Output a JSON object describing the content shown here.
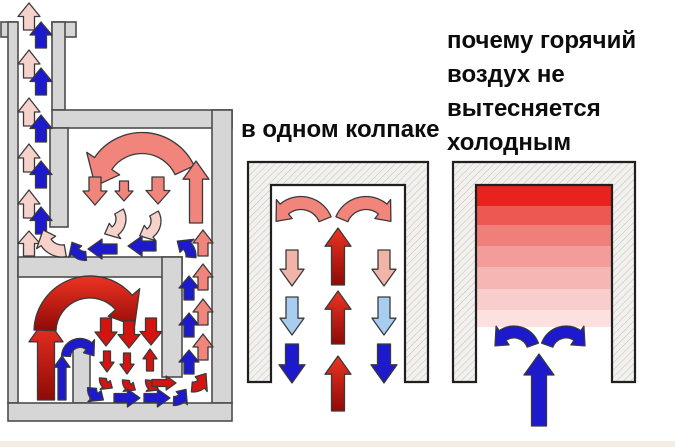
{
  "palette": {
    "hot_red": "#d41410",
    "red_deep": "#8f0a06",
    "red_bright": "#ee3323",
    "salmon": "#f2857b",
    "blush": "#f2b4a9",
    "pale_pink": "#f6d2cb",
    "dark_blue": "#1d19cd",
    "light_blue": "#a9cdf1",
    "wall_gray": "#d6d6d6",
    "wall_outline": "#4c4c4c",
    "bell_outline": "#1f1f1f",
    "hatch_line": "#c3c3c3",
    "hatch_bg": "#f2f1ee",
    "arrow_outline": "#3a3a3a",
    "title_color": "#0c0c0c",
    "footer_stripe": "#f4ece7"
  },
  "diagrams": {
    "two_bell_stove": {
      "arrows": [
        {
          "t": "s",
          "x1": 29,
          "y1": 30,
          "x2": 29,
          "y2": 3,
          "w": 11,
          "c": "pale_pink"
        },
        {
          "t": "s",
          "x1": 29,
          "y1": 78,
          "x2": 29,
          "y2": 50,
          "w": 11,
          "c": "pale_pink"
        },
        {
          "t": "s",
          "x1": 29,
          "y1": 126,
          "x2": 29,
          "y2": 98,
          "w": 11,
          "c": "pale_pink"
        },
        {
          "t": "s",
          "x1": 29,
          "y1": 172,
          "x2": 29,
          "y2": 144,
          "w": 11,
          "c": "pale_pink"
        },
        {
          "t": "s",
          "x1": 29,
          "y1": 218,
          "x2": 29,
          "y2": 190,
          "w": 11,
          "c": "pale_pink"
        },
        {
          "t": "s",
          "x1": 29,
          "y1": 256,
          "x2": 29,
          "y2": 231,
          "w": 11,
          "c": "pale_pink"
        },
        {
          "t": "s",
          "x1": 41,
          "y1": 48,
          "x2": 41,
          "y2": 22,
          "w": 11,
          "c": "dark_blue"
        },
        {
          "t": "s",
          "x1": 41,
          "y1": 95,
          "x2": 41,
          "y2": 68,
          "w": 11,
          "c": "dark_blue"
        },
        {
          "t": "s",
          "x1": 41,
          "y1": 142,
          "x2": 41,
          "y2": 115,
          "w": 11,
          "c": "dark_blue"
        },
        {
          "t": "s",
          "x1": 41,
          "y1": 188,
          "x2": 41,
          "y2": 161,
          "w": 11,
          "c": "dark_blue"
        },
        {
          "t": "s",
          "x1": 41,
          "y1": 234,
          "x2": 41,
          "y2": 207,
          "w": 11,
          "c": "dark_blue"
        },
        {
          "t": "a",
          "cx": 142,
          "cy": 190,
          "r": 47,
          "w": 21,
          "a0": -25,
          "a1": -175,
          "hl": 24,
          "c": "salmon"
        },
        {
          "t": "s",
          "x1": 95,
          "y1": 177,
          "x2": 95,
          "y2": 205,
          "w": 12,
          "c": "salmon"
        },
        {
          "t": "s",
          "x1": 124,
          "y1": 181,
          "x2": 124,
          "y2": 201,
          "w": 9,
          "c": "salmon"
        },
        {
          "t": "s",
          "x1": 158,
          "y1": 177,
          "x2": 158,
          "y2": 204,
          "w": 12,
          "c": "salmon"
        },
        {
          "t": "s",
          "x1": 196,
          "y1": 223,
          "x2": 196,
          "y2": 161,
          "w": 13,
          "c": "salmon"
        },
        {
          "t": "s",
          "x1": 203,
          "y1": 256,
          "x2": 203,
          "y2": 230,
          "w": 10,
          "c": "salmon"
        },
        {
          "t": "a",
          "cx": 106,
          "cy": 219,
          "r": 15,
          "w": 10,
          "a0": -30,
          "a1": 95,
          "hl": 11,
          "c": "pale_pink"
        },
        {
          "t": "a",
          "cx": 141,
          "cy": 221,
          "r": 15,
          "w": 10,
          "a0": -30,
          "a1": 95,
          "hl": 11,
          "c": "pale_pink"
        },
        {
          "t": "a",
          "cx": 62,
          "cy": 232,
          "r": 19,
          "w": 12,
          "a0": 80,
          "a1": 186,
          "hl": 13,
          "c": "pale_pink"
        },
        {
          "t": "s",
          "x1": 117,
          "y1": 249,
          "x2": 88,
          "y2": 249,
          "w": 10,
          "c": "dark_blue"
        },
        {
          "t": "s",
          "x1": 156,
          "y1": 246,
          "x2": 128,
          "y2": 246,
          "w": 10,
          "c": "dark_blue"
        },
        {
          "t": "a",
          "cx": 176,
          "cy": 256,
          "r": 15,
          "w": 10,
          "a0": 5,
          "a1": -85,
          "hl": 11,
          "c": "dark_blue"
        },
        {
          "t": "a",
          "cx": 85,
          "cy": 243,
          "r": 13,
          "w": 9,
          "a0": 85,
          "a1": 183,
          "hl": 10,
          "c": "dark_blue"
        },
        {
          "t": "s",
          "x1": 46,
          "y1": 400,
          "x2": 46,
          "y2": 318,
          "w": 17,
          "c": "red_grad"
        },
        {
          "t": "a",
          "cx": 90,
          "cy": 332,
          "r": 45,
          "w": 22,
          "a0": 182,
          "a1": 352,
          "hl": 26,
          "c": "red_grad"
        },
        {
          "t": "s",
          "x1": 106,
          "y1": 318,
          "x2": 106,
          "y2": 346,
          "w": 11,
          "c": "hot_red"
        },
        {
          "t": "s",
          "x1": 129,
          "y1": 321,
          "x2": 129,
          "y2": 348,
          "w": 11,
          "c": "hot_red"
        },
        {
          "t": "s",
          "x1": 151,
          "y1": 318,
          "x2": 151,
          "y2": 345,
          "w": 11,
          "c": "hot_red"
        },
        {
          "t": "s",
          "x1": 107,
          "y1": 351,
          "x2": 107,
          "y2": 372,
          "w": 7,
          "c": "hot_red"
        },
        {
          "t": "s",
          "x1": 127,
          "y1": 353,
          "x2": 127,
          "y2": 374,
          "w": 7,
          "c": "hot_red"
        },
        {
          "t": "s",
          "x1": 150,
          "y1": 371,
          "x2": 150,
          "y2": 349,
          "w": 7,
          "c": "hot_red"
        },
        {
          "t": "a",
          "cx": 112,
          "cy": 379,
          "r": 9,
          "w": 7,
          "a0": 185,
          "a1": 88,
          "hl": 8,
          "c": "hot_red"
        },
        {
          "t": "a",
          "cx": 135,
          "cy": 381,
          "r": 9,
          "w": 7,
          "a0": 185,
          "a1": 88,
          "hl": 8,
          "c": "hot_red"
        },
        {
          "t": "a",
          "cx": 158,
          "cy": 381,
          "r": 9,
          "w": 7,
          "a0": 185,
          "a1": 88,
          "hl": 8,
          "c": "hot_red"
        },
        {
          "t": "a",
          "cx": 80,
          "cy": 357,
          "r": 14,
          "w": 9,
          "a0": 183,
          "a1": 355,
          "hl": 11,
          "c": "dark_blue"
        },
        {
          "t": "s",
          "x1": 62,
          "y1": 400,
          "x2": 62,
          "y2": 356,
          "w": 8,
          "c": "dark_blue"
        },
        {
          "t": "a",
          "cx": 103,
          "cy": 389,
          "r": 11,
          "w": 9,
          "a0": 185,
          "a1": 88,
          "hl": 10,
          "c": "dark_blue"
        },
        {
          "t": "s",
          "x1": 114,
          "y1": 398,
          "x2": 140,
          "y2": 398,
          "w": 9,
          "c": "dark_blue"
        },
        {
          "t": "s",
          "x1": 144,
          "y1": 398,
          "x2": 170,
          "y2": 398,
          "w": 9,
          "c": "dark_blue"
        },
        {
          "t": "a",
          "cx": 174,
          "cy": 389,
          "r": 12,
          "w": 9,
          "a0": 92,
          "a1": 2,
          "hl": 10,
          "c": "dark_blue"
        },
        {
          "t": "s",
          "x1": 152,
          "y1": 383,
          "x2": 176,
          "y2": 383,
          "w": 7,
          "c": "hot_red"
        },
        {
          "t": "a",
          "cx": 193,
          "cy": 374,
          "r": 13,
          "w": 10,
          "a0": 95,
          "a1": -2,
          "hl": 12,
          "c": "hot_red"
        },
        {
          "t": "s",
          "x1": 189,
          "y1": 300,
          "x2": 189,
          "y2": 276,
          "w": 10,
          "c": "dark_blue"
        },
        {
          "t": "s",
          "x1": 189,
          "y1": 337,
          "x2": 189,
          "y2": 313,
          "w": 10,
          "c": "dark_blue"
        },
        {
          "t": "s",
          "x1": 189,
          "y1": 374,
          "x2": 189,
          "y2": 350,
          "w": 10,
          "c": "dark_blue"
        },
        {
          "t": "s",
          "x1": 203,
          "y1": 290,
          "x2": 203,
          "y2": 264,
          "w": 10,
          "c": "salmon"
        },
        {
          "t": "s",
          "x1": 203,
          "y1": 325,
          "x2": 203,
          "y2": 299,
          "w": 10,
          "c": "salmon"
        },
        {
          "t": "s",
          "x1": 203,
          "y1": 360,
          "x2": 203,
          "y2": 334,
          "w": 10,
          "c": "salmon"
        }
      ]
    },
    "single_bell": {
      "title": "в одном колпаке",
      "arrows": [
        {
          "t": "a",
          "cx": 301,
          "cy": 229,
          "r": 26,
          "w": 13,
          "a0": -22,
          "a1": -163,
          "hl": 15,
          "c": "salmon"
        },
        {
          "t": "a",
          "cx": 366,
          "cy": 229,
          "r": 26,
          "w": 13,
          "a0": -158,
          "a1": -17,
          "hl": 15,
          "c": "salmon"
        },
        {
          "t": "s",
          "x1": 338,
          "y1": 285,
          "x2": 338,
          "y2": 228,
          "w": 13,
          "c": "red_grad"
        },
        {
          "t": "s",
          "x1": 338,
          "y1": 344,
          "x2": 338,
          "y2": 291,
          "w": 13,
          "c": "red_grad"
        },
        {
          "t": "s",
          "x1": 338,
          "y1": 411,
          "x2": 338,
          "y2": 356,
          "w": 13,
          "c": "red_grad"
        },
        {
          "t": "s",
          "x1": 292,
          "y1": 250,
          "x2": 292,
          "y2": 286,
          "w": 12,
          "c": "blush"
        },
        {
          "t": "s",
          "x1": 384,
          "y1": 250,
          "x2": 384,
          "y2": 286,
          "w": 12,
          "c": "blush"
        },
        {
          "t": "s",
          "x1": 292,
          "y1": 297,
          "x2": 292,
          "y2": 335,
          "w": 12,
          "c": "light_blue"
        },
        {
          "t": "s",
          "x1": 384,
          "y1": 297,
          "x2": 384,
          "y2": 335,
          "w": 12,
          "c": "light_blue"
        },
        {
          "t": "s",
          "x1": 292,
          "y1": 344,
          "x2": 292,
          "y2": 383,
          "w": 13,
          "c": "dark_blue"
        },
        {
          "t": "s",
          "x1": 384,
          "y1": 344,
          "x2": 384,
          "y2": 383,
          "w": 13,
          "c": "dark_blue"
        }
      ]
    },
    "cold_displacement": {
      "title_lines": [
        "почему горячий",
        "воздух не",
        "вытесняется",
        "холодным"
      ],
      "temperature_bands": [
        {
          "y": 186,
          "h": 20,
          "color": "#e8231d"
        },
        {
          "y": 206,
          "h": 19,
          "color": "#ed5852"
        },
        {
          "y": 225,
          "h": 21,
          "color": "#f07e79"
        },
        {
          "y": 246,
          "h": 21,
          "color": "#f29d99"
        },
        {
          "y": 267,
          "h": 22,
          "color": "#f5b7b4"
        },
        {
          "y": 289,
          "h": 21,
          "color": "#f8cecd"
        },
        {
          "y": 310,
          "h": 17,
          "color": "#fce1e0"
        }
      ],
      "arrows": [
        {
          "t": "a",
          "cx": 514,
          "cy": 352,
          "r": 20,
          "w": 12,
          "a0": -20,
          "a1": -162,
          "hl": 13,
          "c": "dark_blue"
        },
        {
          "t": "a",
          "cx": 566,
          "cy": 352,
          "r": 20,
          "w": 12,
          "a0": -160,
          "a1": -18,
          "hl": 13,
          "c": "dark_blue"
        },
        {
          "t": "s",
          "x1": 539,
          "y1": 426,
          "x2": 539,
          "y2": 354,
          "w": 15,
          "c": "dark_blue"
        }
      ]
    }
  }
}
